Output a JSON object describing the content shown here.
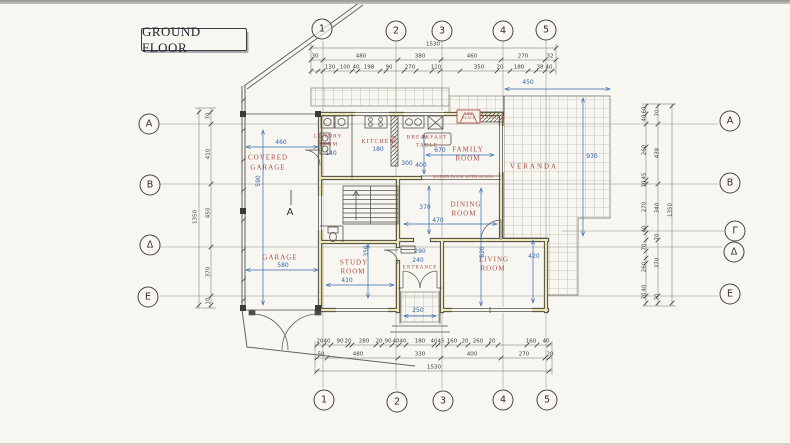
{
  "title_box": {
    "label": "GROUND FLOOR"
  },
  "colors": {
    "paper": "#f8f6f1",
    "ink": "#3e3d38",
    "blue_dim": "#3463a8",
    "red_label": "#a84a41",
    "wall_highlight": "#ece7b5"
  },
  "grid_markers": [
    {
      "label": "1",
      "x": 322,
      "y": 29
    },
    {
      "label": "2",
      "x": 396,
      "y": 31
    },
    {
      "label": "3",
      "x": 442,
      "y": 31
    },
    {
      "label": "4",
      "x": 503,
      "y": 31
    },
    {
      "label": "5",
      "x": 546,
      "y": 30
    },
    {
      "label": "1",
      "x": 324,
      "y": 400
    },
    {
      "label": "2",
      "x": 397,
      "y": 402
    },
    {
      "label": "3",
      "x": 443,
      "y": 401
    },
    {
      "label": "4",
      "x": 503,
      "y": 400
    },
    {
      "label": "5",
      "x": 547,
      "y": 400
    },
    {
      "label": "A",
      "x": 149,
      "y": 124
    },
    {
      "label": "B",
      "x": 150,
      "y": 185
    },
    {
      "label": "Δ",
      "x": 150,
      "y": 245
    },
    {
      "label": "E",
      "x": 148,
      "y": 297
    },
    {
      "label": "A",
      "x": 730,
      "y": 121
    },
    {
      "label": "B",
      "x": 730,
      "y": 183
    },
    {
      "label": "Γ",
      "x": 735,
      "y": 231
    },
    {
      "label": "Δ",
      "x": 734,
      "y": 252
    },
    {
      "label": "E",
      "x": 730,
      "y": 294
    }
  ],
  "room_labels": [
    {
      "t": "COVERED",
      "x": 268,
      "y": 158
    },
    {
      "t": "GARAGE",
      "x": 268,
      "y": 168
    },
    {
      "t": "LUNDRY",
      "x": 328,
      "y": 137,
      "size": 5.5
    },
    {
      "t": "ROOM",
      "x": 328,
      "y": 145,
      "size": 5.5
    },
    {
      "t": "KITCHEN",
      "x": 378,
      "y": 142,
      "size": 6
    },
    {
      "t": "BAR",
      "x": 394.5,
      "y": 141,
      "size": 5,
      "rot": -90
    },
    {
      "t": "BREAKFAST",
      "x": 427,
      "y": 138,
      "size": 5.5
    },
    {
      "t": "TABLE",
      "x": 427,
      "y": 146,
      "size": 5.5
    },
    {
      "t": "FAMILY",
      "x": 468,
      "y": 150
    },
    {
      "t": "ROOM",
      "x": 468,
      "y": 159
    },
    {
      "t": "VERANDA",
      "x": 534,
      "y": 167,
      "ls": 2
    },
    {
      "t": "DINING",
      "x": 466,
      "y": 205
    },
    {
      "t": "ROOM",
      "x": 464,
      "y": 214
    },
    {
      "t": "LIVING",
      "x": 494,
      "y": 260
    },
    {
      "t": "ROOM",
      "x": 493,
      "y": 269
    },
    {
      "t": "ENTRANCE",
      "x": 420,
      "y": 268,
      "size": 5
    },
    {
      "t": "STUDY",
      "x": 354,
      "y": 263
    },
    {
      "t": "ROOM",
      "x": 353,
      "y": 272
    },
    {
      "t": "GARAGE",
      "x": 280,
      "y": 258
    }
  ],
  "annotations": [
    {
      "t": "FIRE",
      "x": 469,
      "y": 114.5,
      "size": 3.8
    },
    {
      "t": "PLACE",
      "x": 469,
      "y": 119,
      "size": 3.8
    },
    {
      "t": "TV STATION",
      "x": 492,
      "y": 117.5,
      "size": 4.2
    },
    {
      "t": "SLIDED DOOR WITH GLASS",
      "x": 463,
      "y": 177,
      "size": 4.2
    }
  ],
  "dim_labels_black": [
    {
      "t": "1530",
      "x": 433,
      "y": 45
    },
    {
      "t": "30",
      "x": 315,
      "y": 57
    },
    {
      "t": "480",
      "x": 361,
      "y": 57
    },
    {
      "t": "380",
      "x": 420,
      "y": 57
    },
    {
      "t": "460",
      "x": 472,
      "y": 57
    },
    {
      "t": "270",
      "x": 523,
      "y": 57
    },
    {
      "t": "32",
      "x": 550,
      "y": 57
    },
    {
      "t": "130",
      "x": 330,
      "y": 68
    },
    {
      "t": "100",
      "x": 345,
      "y": 68
    },
    {
      "t": "40",
      "x": 356,
      "y": 68
    },
    {
      "t": "198",
      "x": 369,
      "y": 68
    },
    {
      "t": "90",
      "x": 389,
      "y": 68
    },
    {
      "t": "270",
      "x": 410,
      "y": 68
    },
    {
      "t": "110",
      "x": 436,
      "y": 68
    },
    {
      "t": "350",
      "x": 479,
      "y": 68
    },
    {
      "t": "20",
      "x": 500,
      "y": 68
    },
    {
      "t": "180",
      "x": 519,
      "y": 68
    },
    {
      "t": "38",
      "x": 540,
      "y": 68
    },
    {
      "t": "40",
      "x": 549,
      "y": 68
    },
    {
      "t": "20",
      "x": 320,
      "y": 342
    },
    {
      "t": "40",
      "x": 327,
      "y": 342
    },
    {
      "t": "90",
      "x": 340,
      "y": 342
    },
    {
      "t": "20",
      "x": 348,
      "y": 342
    },
    {
      "t": "280",
      "x": 364,
      "y": 342
    },
    {
      "t": "20",
      "x": 379,
      "y": 342
    },
    {
      "t": "90",
      "x": 388,
      "y": 342
    },
    {
      "t": "40",
      "x": 396,
      "y": 342
    },
    {
      "t": "40",
      "x": 403,
      "y": 342
    },
    {
      "t": "180",
      "x": 420,
      "y": 342
    },
    {
      "t": "40",
      "x": 434,
      "y": 342
    },
    {
      "t": "45",
      "x": 441,
      "y": 342
    },
    {
      "t": "160",
      "x": 452,
      "y": 342
    },
    {
      "t": "20",
      "x": 465,
      "y": 342
    },
    {
      "t": "260",
      "x": 478,
      "y": 342
    },
    {
      "t": "20",
      "x": 492,
      "y": 342
    },
    {
      "t": "160",
      "x": 531,
      "y": 342
    },
    {
      "t": "40",
      "x": 546,
      "y": 342
    },
    {
      "t": "50",
      "x": 321,
      "y": 355
    },
    {
      "t": "480",
      "x": 358,
      "y": 355
    },
    {
      "t": "330",
      "x": 420,
      "y": 355
    },
    {
      "t": "400",
      "x": 472,
      "y": 355
    },
    {
      "t": "270",
      "x": 524,
      "y": 355
    },
    {
      "t": "20",
      "x": 550,
      "y": 355
    },
    {
      "t": "1530",
      "x": 434,
      "y": 368
    },
    {
      "t": "70",
      "x": 209,
      "y": 116,
      "rot": -90
    },
    {
      "t": "410",
      "x": 209,
      "y": 154,
      "rot": -90
    },
    {
      "t": "450",
      "x": 209,
      "y": 213,
      "rot": -90
    },
    {
      "t": "370",
      "x": 209,
      "y": 272,
      "rot": -90
    },
    {
      "t": "10",
      "x": 209,
      "y": 301,
      "rot": -90
    },
    {
      "t": "1350",
      "x": 196,
      "y": 217,
      "rot": -90
    },
    {
      "t": "60",
      "x": 645,
      "y": 110,
      "rot": -90
    },
    {
      "t": "40",
      "x": 645,
      "y": 118,
      "rot": -90
    },
    {
      "t": "260",
      "x": 645,
      "y": 150,
      "rot": -90
    },
    {
      "t": "45",
      "x": 645,
      "y": 176,
      "rot": -90
    },
    {
      "t": "70",
      "x": 645,
      "y": 184,
      "rot": -90
    },
    {
      "t": "270",
      "x": 645,
      "y": 207,
      "rot": -90
    },
    {
      "t": "40",
      "x": 645,
      "y": 229,
      "rot": -90
    },
    {
      "t": "70",
      "x": 645,
      "y": 247,
      "rot": -90
    },
    {
      "t": "260",
      "x": 645,
      "y": 267,
      "rot": -90
    },
    {
      "t": "40",
      "x": 645,
      "y": 288,
      "rot": -90
    },
    {
      "t": "70",
      "x": 645,
      "y": 296,
      "rot": -90
    },
    {
      "t": "70",
      "x": 658,
      "y": 113,
      "rot": -90
    },
    {
      "t": "438",
      "x": 658,
      "y": 153,
      "rot": -90
    },
    {
      "t": "340",
      "x": 658,
      "y": 208,
      "rot": -90
    },
    {
      "t": "70",
      "x": 658,
      "y": 237,
      "rot": -90
    },
    {
      "t": "370",
      "x": 658,
      "y": 263,
      "rot": -90
    },
    {
      "t": "70",
      "x": 658,
      "y": 297,
      "rot": -90
    },
    {
      "t": "1350",
      "x": 671,
      "y": 210,
      "rot": -90
    }
  ],
  "dim_labels_blue": [
    {
      "t": "460",
      "x": 281,
      "y": 143
    },
    {
      "t": "590",
      "x": 259,
      "y": 181,
      "rot": -90
    },
    {
      "t": "140",
      "x": 331,
      "y": 154
    },
    {
      "t": "180",
      "x": 378,
      "y": 150
    },
    {
      "t": "300",
      "x": 407,
      "y": 164
    },
    {
      "t": "400",
      "x": 421,
      "y": 166
    },
    {
      "t": "670",
      "x": 440,
      "y": 151
    },
    {
      "t": "370",
      "x": 425,
      "y": 208
    },
    {
      "t": "470",
      "x": 438,
      "y": 221
    },
    {
      "t": "820",
      "x": 483,
      "y": 252,
      "rot": -90
    },
    {
      "t": "290",
      "x": 420,
      "y": 252
    },
    {
      "t": "240",
      "x": 418,
      "y": 261
    },
    {
      "t": "420",
      "x": 534,
      "y": 257
    },
    {
      "t": "350",
      "x": 367,
      "y": 251,
      "rot": -90
    },
    {
      "t": "410",
      "x": 347,
      "y": 281
    },
    {
      "t": "580",
      "x": 283,
      "y": 266
    },
    {
      "t": "930",
      "x": 592,
      "y": 157
    },
    {
      "t": "450",
      "x": 528,
      "y": 83
    },
    {
      "t": "250",
      "x": 418,
      "y": 311
    }
  ],
  "section_marker": {
    "t": "A",
    "x": 290,
    "y": 213
  }
}
